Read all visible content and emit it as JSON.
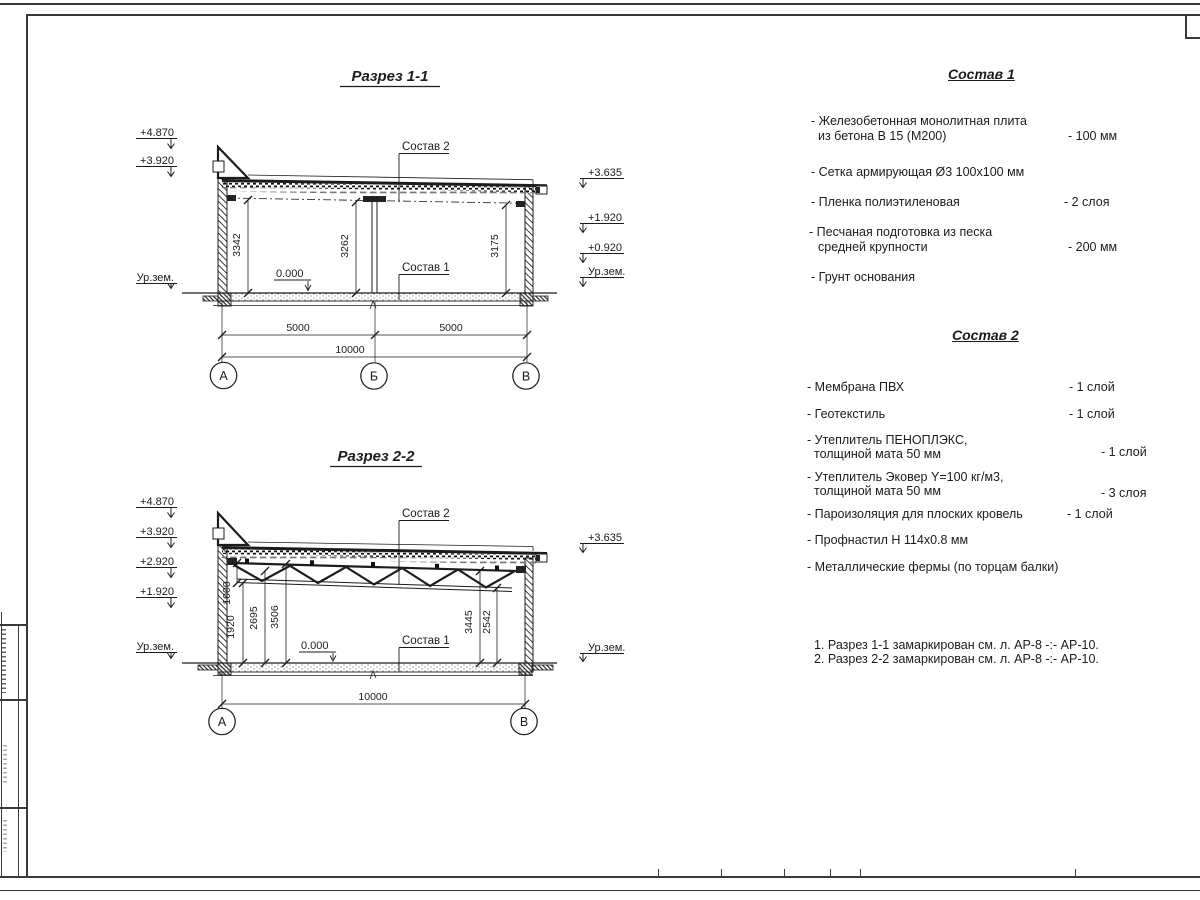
{
  "section1": {
    "title": "Разрез 1-1",
    "levels_left": [
      "+4.870",
      "+3.920",
      "Ур.зем."
    ],
    "levels_right": [
      "+3.635",
      "+1.920",
      "+0.920",
      "Ур.зем."
    ],
    "dims": {
      "h1": "3342",
      "h2": "3262",
      "h3": "3175",
      "b1": "5000",
      "b2": "5000",
      "total": "10000"
    },
    "zero": "0.000",
    "leader_top": "Состав 2",
    "leader_bottom": "Состав 1",
    "axes": [
      "А",
      "Б",
      "В"
    ]
  },
  "section2": {
    "title": "Разрез 2-2",
    "levels_left": [
      "+4.870",
      "+3.920",
      "+2.920",
      "+1.920",
      "Ур.зем."
    ],
    "levels_right": [
      "+3.635",
      "Ур.зем."
    ],
    "dims": {
      "t1": "1000",
      "h1": "1920",
      "h2": "2695",
      "h3": "3506",
      "h4": "3445",
      "h5": "2542",
      "total": "10000"
    },
    "zero": "0.000",
    "leader_top": "Состав 2",
    "leader_bottom": "Состав 1",
    "axes": [
      "А",
      "В"
    ]
  },
  "sostav1": {
    "title": "Состав 1",
    "items": [
      {
        "l1": "- Железобетонная  монолитная плита",
        "l2": "из бетона В 15 (М200)",
        "value": "- 100 мм"
      },
      {
        "l1": "- Сетка армирующая Ø3 100х100 мм"
      },
      {
        "l1": "- Пленка полиэтиленовая",
        "value": "- 2 слоя"
      },
      {
        "l1": "- Песчаная подготовка из песка",
        "l2": "средней крупности",
        "value": "- 200 мм"
      },
      {
        "l1": "- Грунт основания"
      }
    ]
  },
  "sostav2": {
    "title": "Состав 2",
    "items": [
      {
        "l1": "- Мембрана ПВХ",
        "value": "- 1 слой"
      },
      {
        "l1": "- Геотекстиль",
        "value": "- 1 слой"
      },
      {
        "l1": "- Утеплитель ПЕНОПЛЭКС,",
        "l2": "толщиной мата 50 мм",
        "value": "- 1 слой"
      },
      {
        "l1": "- Утеплитель Эковер Y=100 кг/м3,",
        "l2": "толщиной мата 50 мм",
        "value": "- 3 слоя"
      },
      {
        "l1": "- Пароизоляция для плоских кровель",
        "value": "- 1 слой"
      },
      {
        "l1": "- Профнастил Н 114х0.8 мм"
      },
      {
        "l1": "- Металлические фермы (по торцам балки)"
      }
    ]
  },
  "notes": [
    "1. Разрез 1-1 замаркирован см. л. АР-8 -:- АР-10.",
    "2. Разрез 2-2 замаркирован см. л. АР-8 -:- АР-10."
  ]
}
